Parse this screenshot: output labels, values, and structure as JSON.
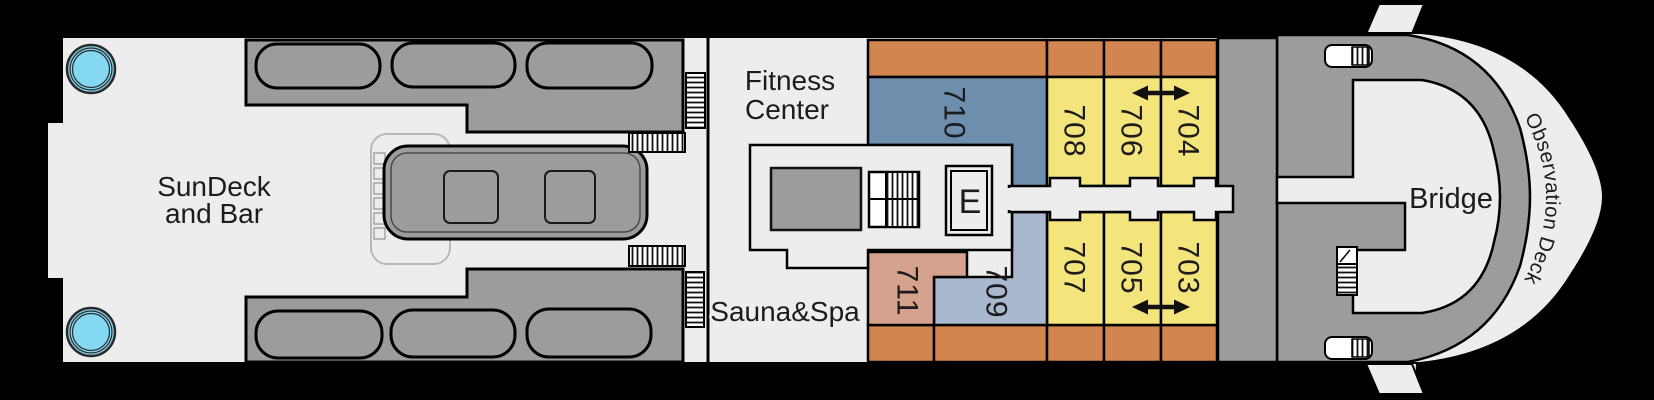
{
  "title": "Ship deck plan",
  "areas": {
    "sundeck": {
      "line1": "SunDeck",
      "line2": "and Bar"
    },
    "fitness": {
      "line1": "Fitness",
      "line2": "Center"
    },
    "sauna_spa": {
      "label": "Sauna&Spa"
    },
    "bridge": {
      "label": "Bridge"
    },
    "observation_deck": {
      "label": "Observation Deck"
    },
    "elevator": {
      "label": "E"
    }
  },
  "cabins": {
    "c710": {
      "number": "710",
      "color": "#6E8EAD",
      "side": "top"
    },
    "c708": {
      "number": "708",
      "color": "#F4E47C",
      "side": "top"
    },
    "c706": {
      "number": "706",
      "color": "#F4E47C",
      "side": "top"
    },
    "c704": {
      "number": "704",
      "color": "#F4E47C",
      "side": "top"
    },
    "c711": {
      "number": "711",
      "color": "#D5A28D",
      "side": "bottom"
    },
    "c709": {
      "number": "709",
      "color": "#A9B7CF",
      "side": "bottom"
    },
    "c707": {
      "number": "707",
      "color": "#F4E47C",
      "side": "bottom"
    },
    "c705": {
      "number": "705",
      "color": "#F4E47C",
      "side": "bottom"
    },
    "c703": {
      "number": "703",
      "color": "#F4E47C",
      "side": "bottom"
    }
  },
  "connecting_door_arrows": [
    "706-704",
    "705-703"
  ],
  "icons": {
    "stairs": "hatched-strip",
    "elevator_glyph": "E",
    "connecting_door": "double-arrow",
    "hot_tub": "cyan-circle",
    "mooring_winch": "capsule-with-hatch"
  },
  "colors": {
    "hull": "#000000",
    "deck": "#ededed",
    "structure_gray": "#9c9c9c",
    "balcony_orange": "#D2854F",
    "cabin_yellow": "#F4E47C",
    "cabin_steel_blue": "#6E8EAD",
    "cabin_light_blue": "#A9B7CF",
    "cabin_salmon": "#D5A28D",
    "hot_tub_cyan": "#85D8F2",
    "outline": "#0a0a0a"
  }
}
